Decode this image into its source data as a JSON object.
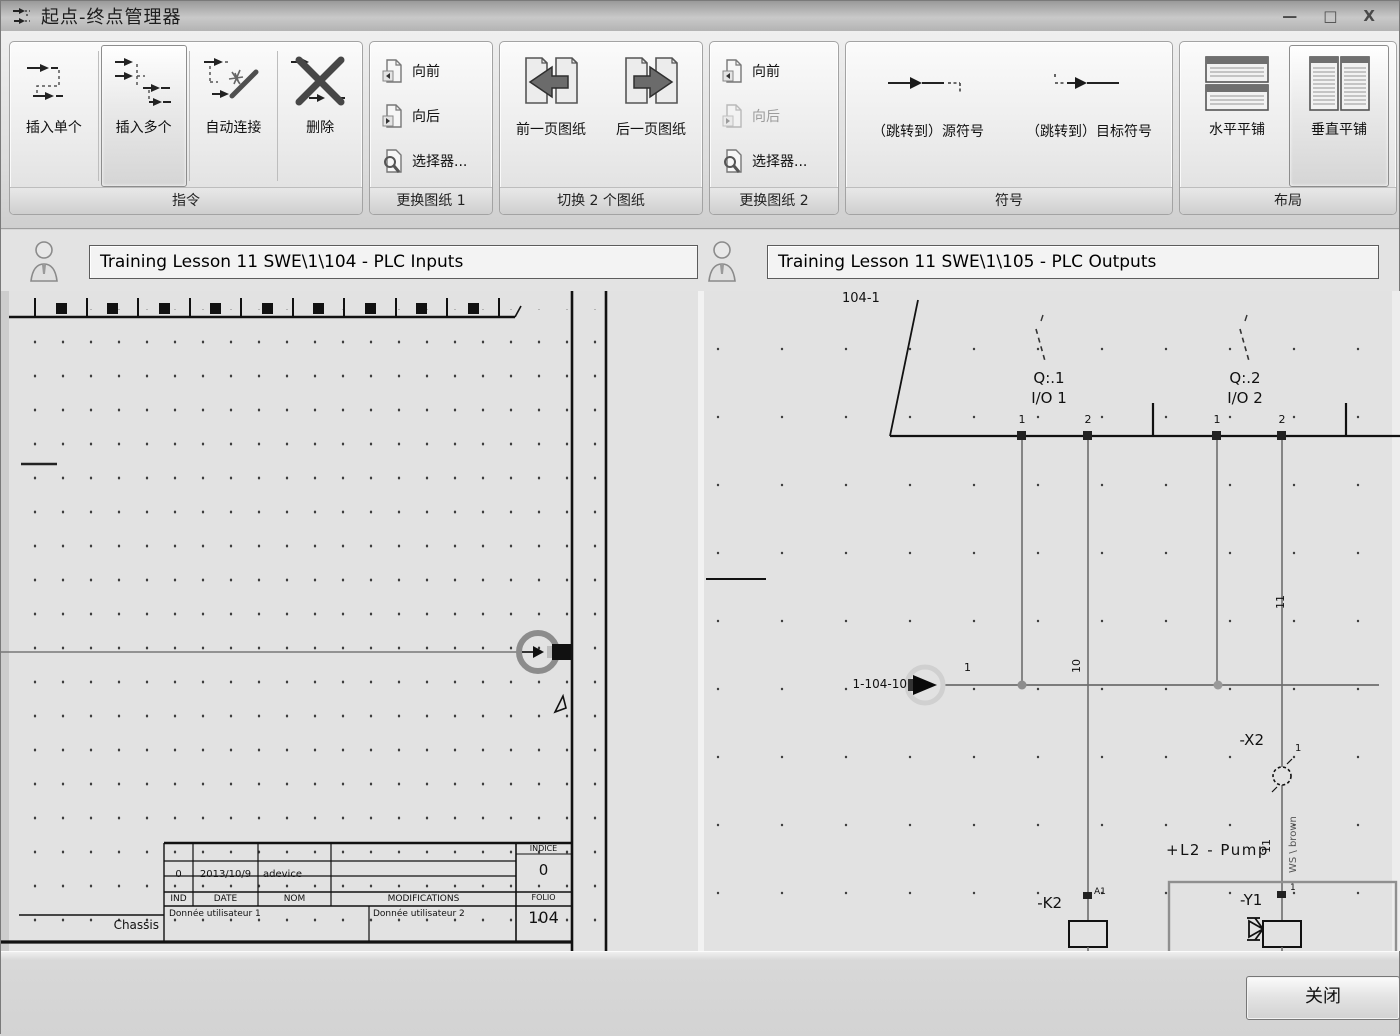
{
  "window": {
    "title": "起点-终点管理器",
    "minimize": "—",
    "maximize": "□",
    "close": "X"
  },
  "colors": {
    "selected_button_border": "#8d8d8d",
    "sheet_background": "#e2e2e2",
    "wire_gray": "#6e6e6e",
    "line_black": "#111111"
  },
  "ribbon": {
    "groups": [
      {
        "name": "指令",
        "buttons": [
          {
            "label": "插入单个",
            "selected": false
          },
          {
            "label": "插入多个",
            "selected": true
          },
          {
            "label": "自动连接",
            "selected": false
          },
          {
            "label": "删除",
            "selected": false
          }
        ]
      },
      {
        "name": "更换图纸 1",
        "buttons": [
          {
            "label": "向前",
            "disabled": false
          },
          {
            "label": "向后",
            "disabled": false
          },
          {
            "label": "选择器...",
            "disabled": false
          }
        ]
      },
      {
        "name": "切换 2 个图纸",
        "buttons": [
          {
            "label": "前一页图纸"
          },
          {
            "label": "后一页图纸"
          }
        ]
      },
      {
        "name": "更换图纸 2",
        "buttons": [
          {
            "label": "向前",
            "disabled": false
          },
          {
            "label": "向后",
            "disabled": true
          },
          {
            "label": "选择器...",
            "disabled": false
          }
        ]
      },
      {
        "name": "符号",
        "buttons": [
          {
            "label": "（跳转到）源符号"
          },
          {
            "label": "（跳转到）目标符号"
          }
        ]
      },
      {
        "name": "布局",
        "buttons": [
          {
            "label": "水平平铺",
            "selected": false
          },
          {
            "label": "垂直平铺",
            "selected": true
          }
        ]
      }
    ]
  },
  "headers": {
    "left": "Training Lesson 11 SWE\\1\\104 - PLC Inputs",
    "right": "Training Lesson 11 SWE\\1\\105 - PLC Outputs"
  },
  "left_sheet": {
    "titleblock": {
      "ind_value": "0",
      "date_value": "2013/10/9",
      "nom_value": "adevice",
      "ind": "IND",
      "date": "DATE",
      "nom": "NOM",
      "modifications": "MODIFICATIONS",
      "user1": "Donnée utilisateur 1",
      "user2": "Donnée utilisateur 2",
      "indice_label": "INDICE",
      "indice_value": "0",
      "folio_label": "FOLIO",
      "folio_value": "104",
      "chassis": "Chassis"
    }
  },
  "right_sheet": {
    "sheet_ref": "104-1",
    "q1": "Q:.1",
    "io1": "I/O 1",
    "q2": "Q:.2",
    "io2": "I/O 2",
    "pin1a": "1",
    "pin2a": "2",
    "pin1b": "1",
    "pin2b": "2",
    "wire_ref": "1-104-10",
    "wire_num": "1",
    "wire10": "10",
    "wire11_top": "11",
    "wire11_bottom": "11",
    "cable": "WS \\ brown",
    "x2": "-X2",
    "x2_pin": "1",
    "l2": "+L2 - Pump",
    "k2": "-K2",
    "k2_pin": "A1",
    "y1": "-Y1",
    "y1_pin": "1"
  },
  "footer": {
    "close": "关闭"
  }
}
